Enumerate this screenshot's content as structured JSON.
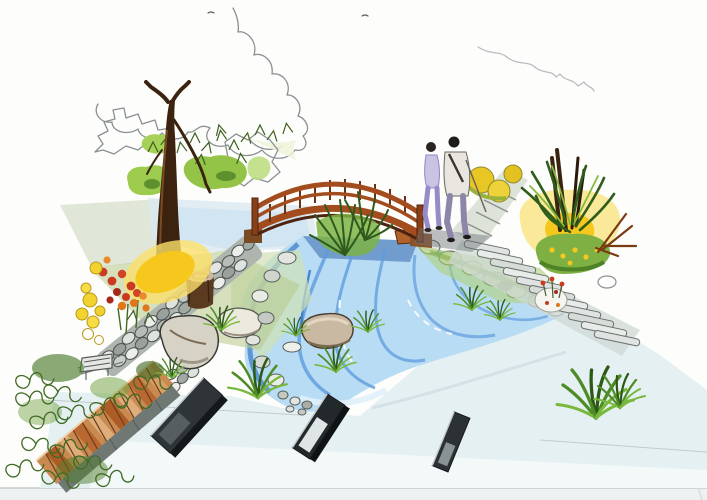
{
  "image": {
    "kind": "hand-drawn marker / colored-pencil landscape design perspective sketch",
    "subject": "garden scene: arched wooden footbridge over a blue stream, a couple strolling on a flagstone path, rock retaining walls, flower beds, yellow shrubs, brick planter and a paved plaza with dark pavers",
    "visible_text": "",
    "people_count": 2
  },
  "palette": {
    "paper": "#fdfdfb",
    "water_light": "#b8dcf4",
    "water_mid": "#5e9bdc",
    "water_deep": "#2e6fc0",
    "water_shadow": "#2a5ea8",
    "bridge_wood": "#a34c1e",
    "bridge_wood_dark": "#5f2a0e",
    "foliage_green": "#9ccb4d",
    "foliage_mid": "#7fb043",
    "foliage_dark": "#3f7a2a",
    "leaf_scribble": "#2f4f1f",
    "yellow_accent": "#f6c81d",
    "orange_flower": "#e2761b",
    "red_flower": "#c93a20",
    "trunk_brown": "#3c2310",
    "stone_gray": "#8d9494",
    "stone_light": "#e3e6e0",
    "plaza_wash": "#e4f0f2",
    "brick": "#c88a50",
    "brick_dark": "#a8531f",
    "paver_dark": "#2e3437",
    "people_purple": "#968bc7",
    "pencil": "#8a9093"
  }
}
